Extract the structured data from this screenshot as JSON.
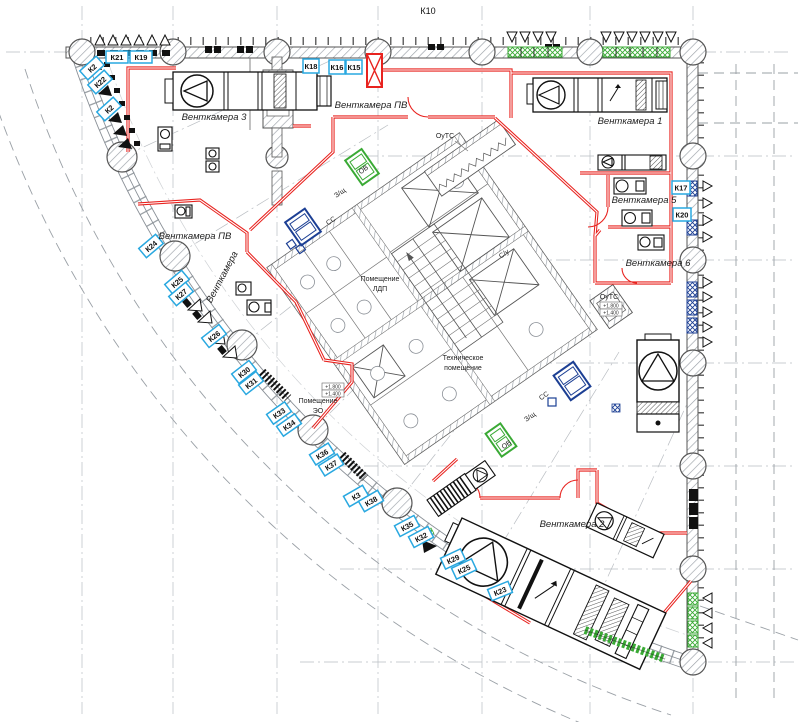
{
  "labels": {
    "k10": "К10",
    "vk3": "Венткамера 3",
    "vk_pv_top": "Венткамера ПВ",
    "vk1": "Венткамера 1",
    "vk5": "Венткамера 5",
    "vk6": "Венткамера 6",
    "vk_pv_left": "Венткамера ПВ",
    "vk_diag": "Венткамера",
    "vk2": "Венткамера 2",
    "pom_l1": "Помещение",
    "pom_l2": "ЛДП",
    "tech_l1": "Техническое",
    "tech_l2": "помещение",
    "eo_l1": "Помещение",
    "eo_l2": "ЭО",
    "zsh": "З/щ",
    "ss": "СС",
    "ov": "ОВ",
    "su": "С/у",
    "outs": "ОуТС",
    "elev_hi": "+1.800",
    "elev_lo": "+1.400"
  },
  "k_labels": [
    "К21",
    "К19",
    "К2",
    "К22",
    "К2",
    "К18",
    "К16",
    "К15",
    "К17",
    "К20",
    "К24",
    "К25",
    "К27",
    "К26",
    "К30",
    "К31",
    "К33",
    "К34",
    "К36",
    "К37",
    "К3",
    "К38",
    "К35",
    "К32",
    "К29",
    "К25",
    "К23"
  ],
  "colors": {
    "wall_red": "#e8231f",
    "label_blue": "#29a8e0",
    "grille_green": "#3aaa35",
    "equipment_blue": "#1c3f94"
  }
}
